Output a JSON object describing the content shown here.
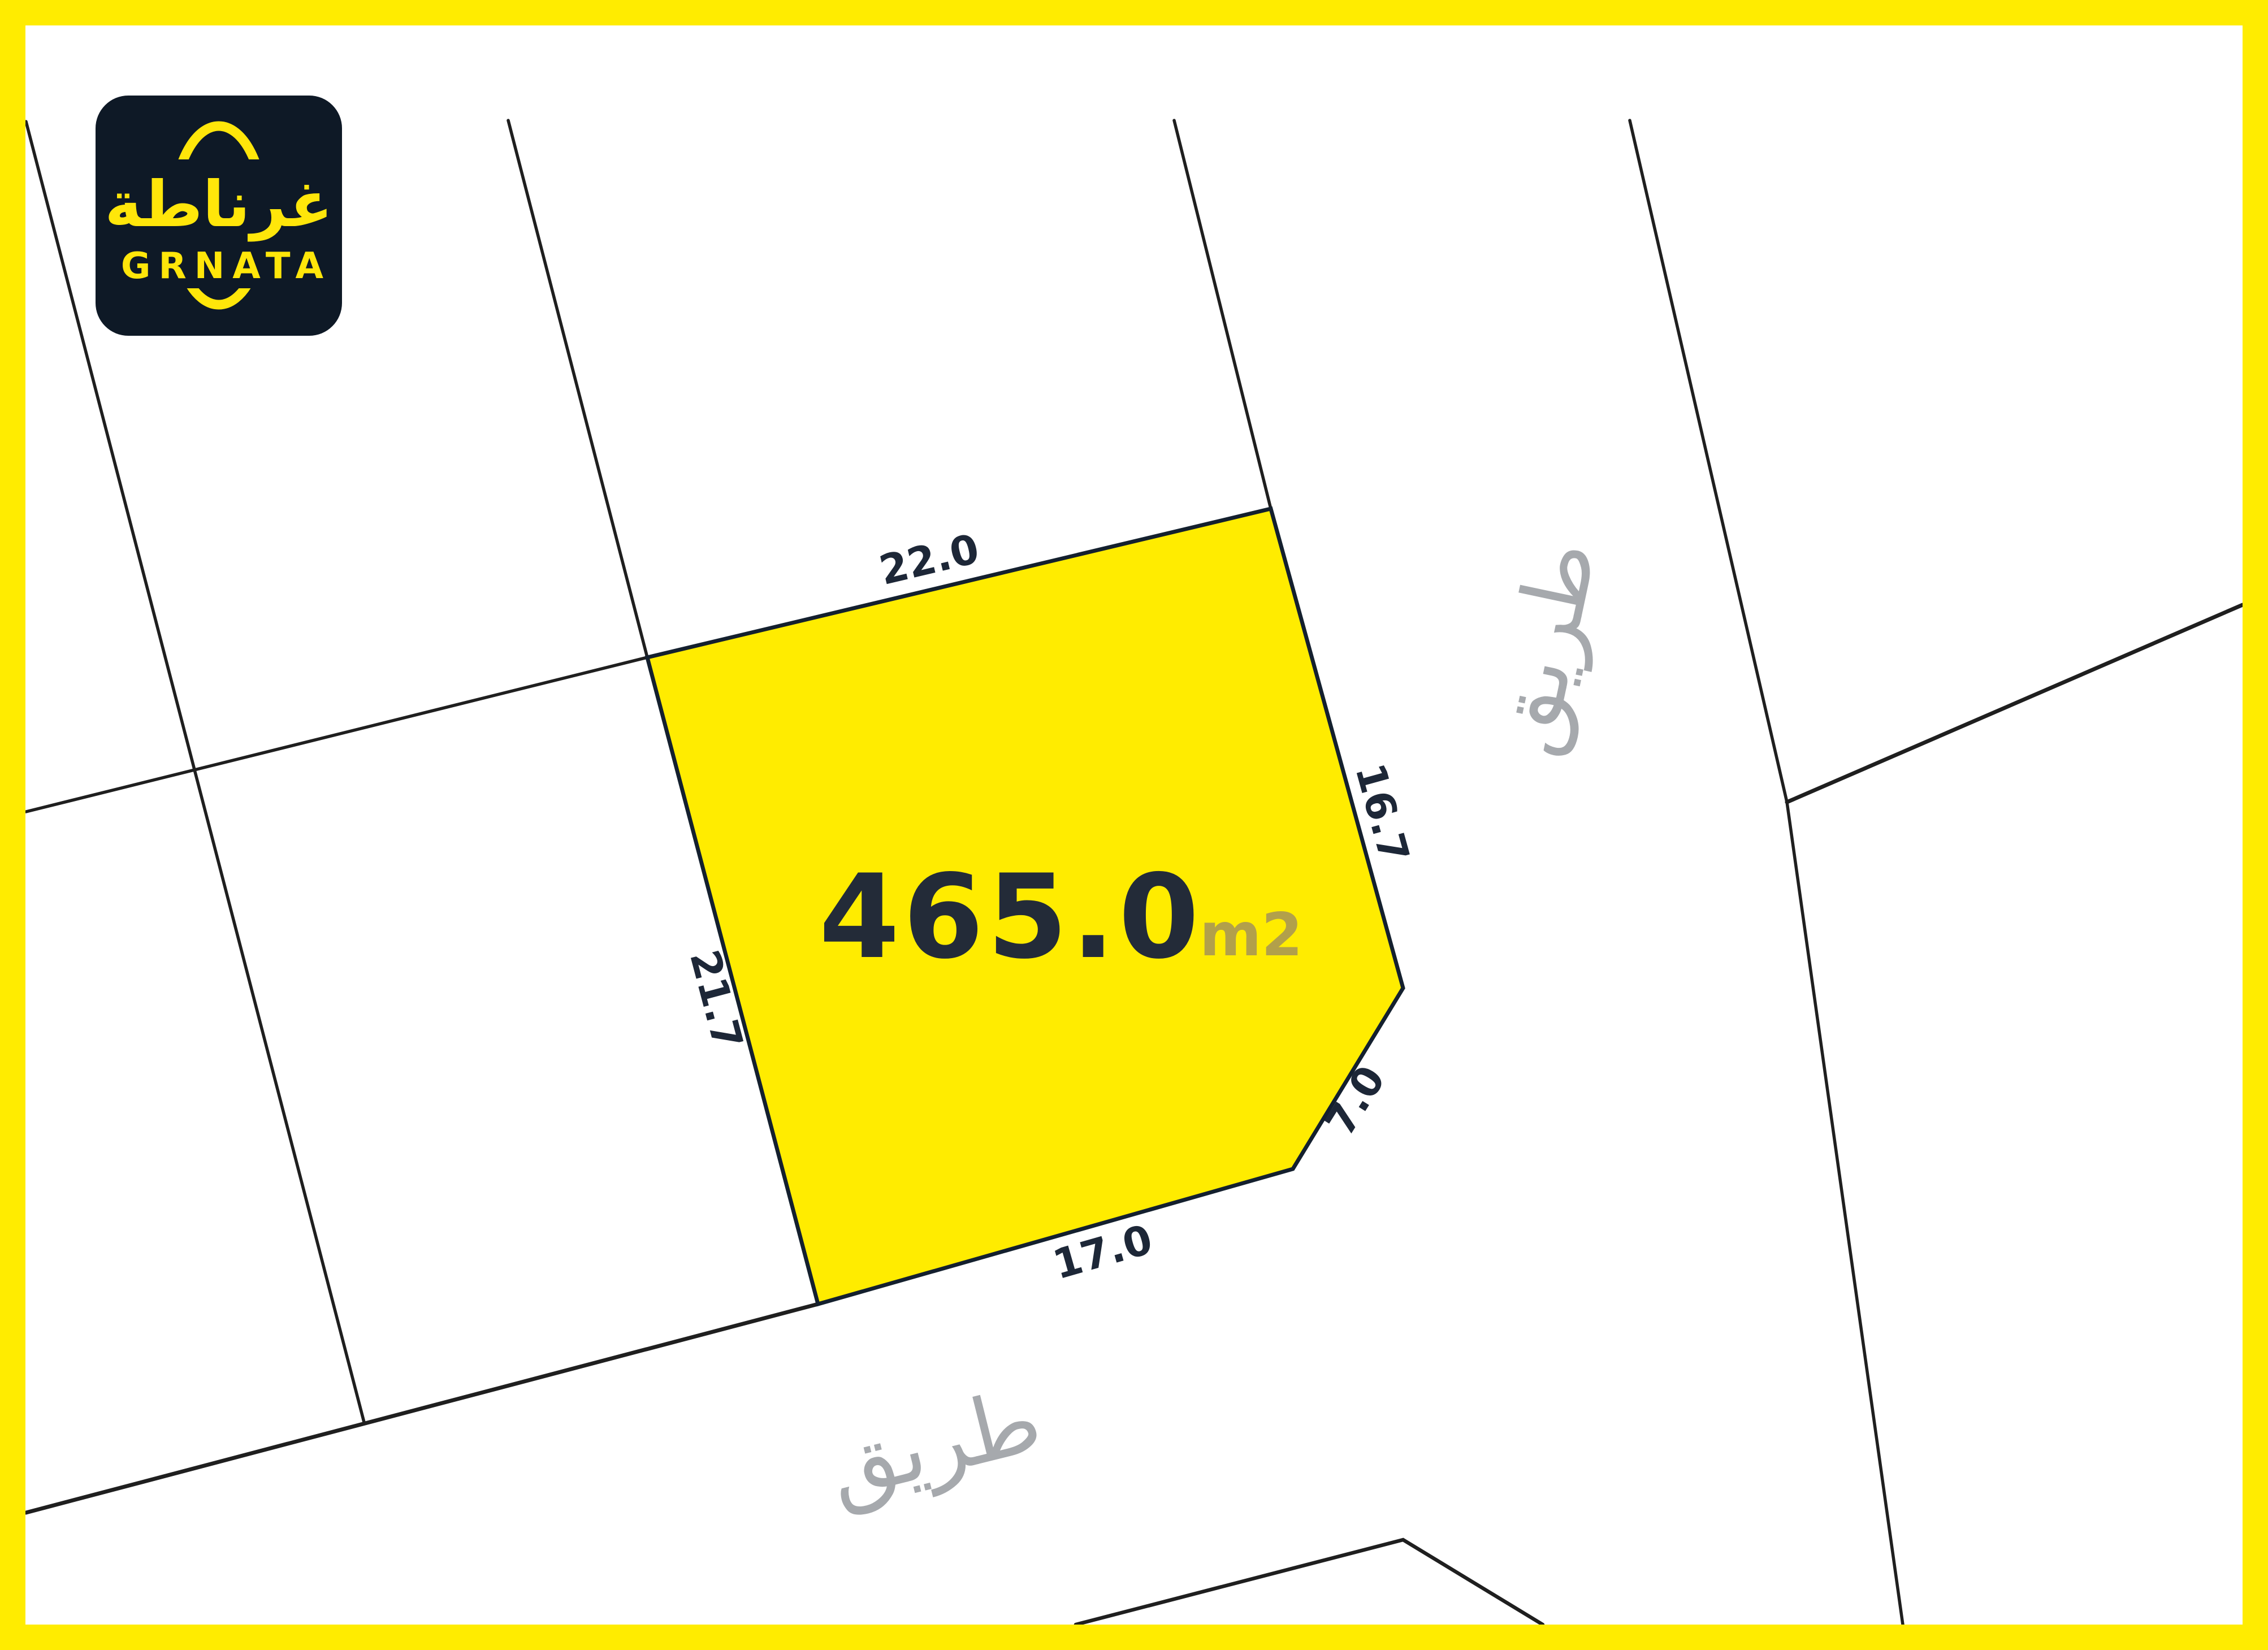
{
  "colors": {
    "frame_yellow": "#ffec00",
    "plot_fill": "#ffec00",
    "plot_border": "#14202e",
    "area_text": "#232b38",
    "unit_text": "#b2a04a",
    "dimension_text": "#1d2737",
    "road_text": "#a6a9ad",
    "parcel_line": "#1f1f1f",
    "logo_bg": "#0e1926",
    "logo_accent": "#ffe60a"
  },
  "logo": {
    "arabic_name": "غرناطة",
    "latin_name": "GRNATA"
  },
  "plot": {
    "area_value": "465.0",
    "area_unit": "m2",
    "dimensions": {
      "top": "22.0",
      "right": "16.7",
      "left": "21.7",
      "corner": "7.0",
      "bottom": "17.0"
    }
  },
  "roads": {
    "right_label": "طريق",
    "bottom_label": "طريق"
  }
}
